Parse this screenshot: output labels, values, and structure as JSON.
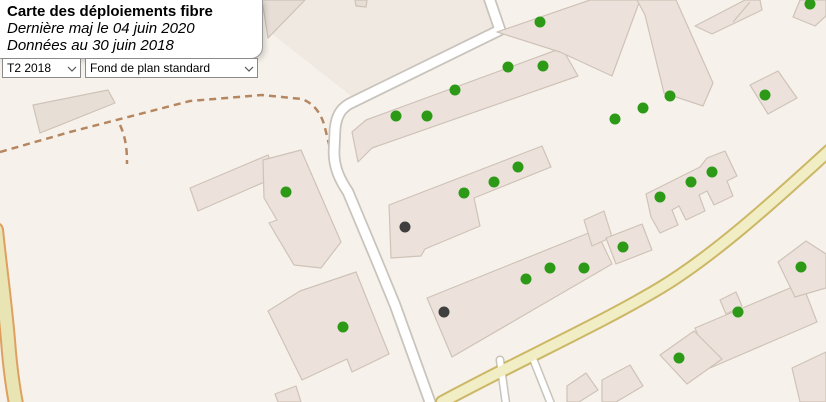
{
  "panel": {
    "title": "Carte des déploiements fibre",
    "subtitle1": "Dernière maj le 04 juin 2020",
    "subtitle2": "Données au 30 juin 2018"
  },
  "controls": {
    "quarter_select": {
      "value": "T2 2018"
    },
    "basemap_select": {
      "value": "Fond de plan standard"
    }
  },
  "map": {
    "colors": {
      "background": "#f6f2eb",
      "parcel": "#f0e9e1",
      "building_fill": "#ece2db",
      "building_fill_dark": "#e7ded6",
      "building_stroke": "#cfc3b8",
      "street_fill": "#ffffff",
      "street_casing": "#c8c3bb",
      "secondary_fill": "#f1edc4",
      "secondary_casing": "#cbb766",
      "track_fill": "#e8e4b3",
      "track_casing": "#dfa05f",
      "path_dashed": "#b5865f",
      "marker_green": "#2d9a17",
      "marker_dark": "#3f3f3f"
    },
    "parcels": [
      "272,34 303,0 489,0 498,30 355,99"
    ],
    "paths_dashed": [
      "M0,152 L70,132 L190,101 L262,95 L302,99 C315,104 322,115 325,128 L330,148",
      "M120,125 C126,138 127,150 127,164"
    ],
    "roads": [
      {
        "type": "track",
        "d": "M-4,230 C0,268 5,305 8,340 C10,368 13,388 16,404",
        "w": 12,
        "cw": 16
      },
      {
        "type": "street",
        "d": "M487,-8 L500,30 L353,102 C341,107 336,116 335,130 L334,152 C334,168 340,180 348,192 L374,254 L395,305 L430,402",
        "w": 9,
        "cw": 12.5
      },
      {
        "type": "street",
        "d": "M500,360 L506,404",
        "w": 6,
        "cw": 9
      },
      {
        "type": "street",
        "d": "M532,356 L551,404",
        "w": 6,
        "cw": 9
      },
      {
        "type": "secondary",
        "d": "M832,148 C790,186 720,252 660,288 C600,324 520,360 442,402",
        "w": 10,
        "cw": 14
      }
    ],
    "buildings": [
      {
        "points": "262,0 305,0 268,38",
        "dark": true
      },
      {
        "points": "33,105 108,90 115,103 40,133",
        "dark": true
      },
      {
        "points": "355,0 367,0 366,7 356,6",
        "dark": true
      },
      {
        "points": "352,132 366,120 562,48 578,76 372,148 358,162",
        "dark": false
      },
      {
        "points": "497,32 590,0 640,0 612,76 560,52",
        "dark": false
      },
      {
        "points": "637,0 676,0 713,83 703,106 664,93 645,15",
        "dark": false
      },
      {
        "points": "695,26 745,0 760,0 762,10 712,34",
        "dark": false
      },
      {
        "points": "793,17 800,0 826,0 826,16 815,26",
        "dark": false
      },
      {
        "points": "750,85 778,71 797,98 768,114",
        "dark": false
      },
      {
        "points": "646,194 700,167 707,158 725,151 737,176 727,181 733,196 714,205 707,191 699,195 705,211 686,220 679,206 672,210 678,225 660,233 651,217",
        "dark": false
      },
      {
        "points": "389,205 542,146 551,167 474,198 480,226 425,249 421,256 391,258",
        "dark": false
      },
      {
        "points": "190,188 268,155 276,177 198,211",
        "dark": false
      },
      {
        "points": "263,160 301,150 341,242 321,268 294,265 269,223 277,220 264,198",
        "dark": false
      },
      {
        "points": "268,311 300,291 356,272 389,354 352,372 347,359 302,380",
        "dark": false
      },
      {
        "points": "427,298 596,230 612,264 452,357",
        "dark": false
      },
      {
        "points": "584,220 604,211 612,237 592,246",
        "dark": false
      },
      {
        "points": "606,238 642,224 652,250 616,264",
        "dark": false
      },
      {
        "points": "695,328 802,283 817,322 710,368",
        "dark": false
      },
      {
        "points": "720,300 736,292 742,306 726,314",
        "dark": false
      },
      {
        "points": "778,262 806,241 826,254 826,288 795,297",
        "dark": false
      },
      {
        "points": "660,355 694,331 722,359 687,384",
        "dark": false
      },
      {
        "points": "567,386 586,373 598,390 579,402 567,402",
        "dark": false
      },
      {
        "points": "602,380 630,365 643,386 616,402 602,402",
        "dark": false
      },
      {
        "points": "792,368 826,352 826,402 800,402",
        "dark": false
      },
      {
        "points": "275,394 296,386 301,402 278,402",
        "dark": false
      }
    ],
    "building_lines": [
      {
        "x1": 733,
        "y1": 22,
        "x2": 750,
        "y2": 2
      }
    ],
    "markers": [
      {
        "x": 540,
        "y": 22,
        "status": "green"
      },
      {
        "x": 508,
        "y": 67,
        "status": "green"
      },
      {
        "x": 543,
        "y": 66,
        "status": "green"
      },
      {
        "x": 455,
        "y": 90,
        "status": "green"
      },
      {
        "x": 396,
        "y": 116,
        "status": "green"
      },
      {
        "x": 427,
        "y": 116,
        "status": "green"
      },
      {
        "x": 810,
        "y": 4,
        "status": "green"
      },
      {
        "x": 765,
        "y": 95,
        "status": "green"
      },
      {
        "x": 615,
        "y": 119,
        "status": "green"
      },
      {
        "x": 643,
        "y": 108,
        "status": "green"
      },
      {
        "x": 670,
        "y": 96,
        "status": "green"
      },
      {
        "x": 660,
        "y": 197,
        "status": "green"
      },
      {
        "x": 691,
        "y": 182,
        "status": "green"
      },
      {
        "x": 712,
        "y": 172,
        "status": "green"
      },
      {
        "x": 286,
        "y": 192,
        "status": "green"
      },
      {
        "x": 464,
        "y": 193,
        "status": "green"
      },
      {
        "x": 494,
        "y": 182,
        "status": "green"
      },
      {
        "x": 518,
        "y": 167,
        "status": "green"
      },
      {
        "x": 623,
        "y": 247,
        "status": "green"
      },
      {
        "x": 526,
        "y": 279,
        "status": "green"
      },
      {
        "x": 550,
        "y": 268,
        "status": "green"
      },
      {
        "x": 584,
        "y": 268,
        "status": "green"
      },
      {
        "x": 343,
        "y": 327,
        "status": "green"
      },
      {
        "x": 738,
        "y": 312,
        "status": "green"
      },
      {
        "x": 801,
        "y": 267,
        "status": "green"
      },
      {
        "x": 679,
        "y": 358,
        "status": "green"
      },
      {
        "x": 405,
        "y": 227,
        "status": "dark"
      },
      {
        "x": 444,
        "y": 312,
        "status": "dark"
      }
    ],
    "marker_radius": 5.5
  }
}
